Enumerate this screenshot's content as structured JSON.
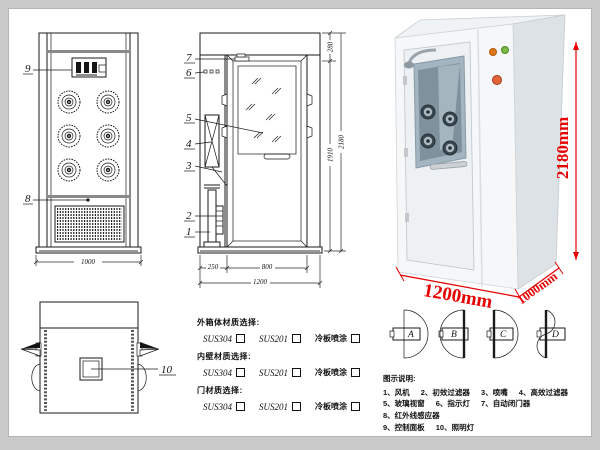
{
  "front_view": {
    "callout_9": "9",
    "callout_8": "8",
    "dim_width": "1000"
  },
  "side_view": {
    "callout_7": "7",
    "callout_6": "6",
    "callout_5": "5",
    "callout_4": "4",
    "callout_3": "3",
    "callout_2": "2",
    "callout_1": "1",
    "dim_280": "280",
    "dim_1910": "1910",
    "dim_2180": "2180",
    "dim_250": "250",
    "dim_800": "800",
    "dim_1200": "1200"
  },
  "top_view": {
    "callout_10": "10"
  },
  "photo": {
    "dim_height": "2180mm",
    "dim_width": "1200mm",
    "dim_depth": "1000mm",
    "accent_color": "#e60000"
  },
  "materials": {
    "groups": [
      {
        "title": "外箱体材质选择:",
        "opt1": "SUS304",
        "opt2": "SUS201",
        "opt3": "冷板喷涂"
      },
      {
        "title": "内壁材质选择:",
        "opt1": "SUS304",
        "opt2": "SUS201",
        "opt3": "冷板喷涂"
      },
      {
        "title": "门材质选择:",
        "opt1": "SUS304",
        "opt2": "SUS201",
        "opt3": "冷板喷涂"
      }
    ]
  },
  "door_options": {
    "a": "A",
    "b": "B",
    "c": "C",
    "d": "D"
  },
  "legend": {
    "title": "图示说明:",
    "row1": [
      "1、风机",
      "2、初效过滤器",
      "3、喷嘴",
      "4、高效过滤器"
    ],
    "row2": [
      "5、玻璃视窗",
      "6、指示灯",
      "7、自动闭门器",
      "8、红外线感应器"
    ],
    "row3": [
      "9、控制面板",
      "10、照明灯"
    ]
  }
}
